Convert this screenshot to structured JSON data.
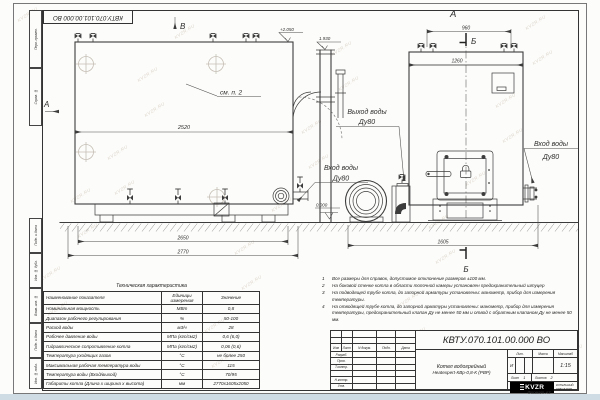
{
  "watermark": "KVZR.RU",
  "stamp": {
    "code": "КВТУ.070.101.00.000  ВО"
  },
  "frame_fields": [
    "Перв. примен.",
    "Справ. №",
    "Подп. и дата",
    "Инв. № дубл.",
    "Взам. инв. №",
    "Подп. и дата",
    "Инв. № подл."
  ],
  "drawing": {
    "view_b_label": "В",
    "view_a_side_label": "А",
    "see_note": "см. п. 2",
    "level_top": "+2.050",
    "level_chimney": "1.930",
    "level_zero": "0.000",
    "dim_2520": "2520",
    "dim_2650": "2650",
    "dim_2770": "2770",
    "front_label": "А",
    "section_label": "Б",
    "dim_960": "960",
    "dim_1260": "1260",
    "dim_1605": "1605",
    "outlet": {
      "line1": "Выход воды",
      "line2": "Ду80"
    },
    "inlet_left": {
      "line1": "Вход воды",
      "line2": "Ду80"
    },
    "inlet_right": {
      "line1": "Вход воды",
      "line2": "Ду80"
    }
  },
  "tech_table": {
    "title": "Техническая характеристика",
    "headers": [
      "Наименование показателя",
      "Единицы измерения",
      "Значение"
    ],
    "rows": [
      [
        "Номинальная мощность",
        "МВт",
        "0,8"
      ],
      [
        "Диапазон рабочего регулирования",
        "%",
        "50-100"
      ],
      [
        "Расход воды",
        "м3/ч",
        "28"
      ],
      [
        "Рабочее давление воды",
        "МПа (кгс/см2)",
        "0,6 (6,0)"
      ],
      [
        "Гидравлическое сопротивление котла",
        "МПа (кгс/см2)",
        "0,06 (0,6)"
      ],
      [
        "Температура уходящих газов",
        "°С",
        "не более 250"
      ],
      [
        "Максимальная рабочая температура воды",
        "°С",
        "115"
      ],
      [
        "Температура воды (Вход/выход)",
        "°С",
        "70/95"
      ],
      [
        "Габариты котла (Длина х ширина х высота)",
        "мм",
        "2770х1605х2050"
      ]
    ]
  },
  "notes": [
    {
      "n": "1",
      "text": "Все размеры для справок, допустимое отклонение размеров ±100 мм."
    },
    {
      "n": "2",
      "text": "На боковой стенке котла в области топочной камеры установлен предохранительный штуцер"
    },
    {
      "n": "3",
      "text": "На подводящей трубе котла, до запорной арматуры установлены: манометр, прибор для измерения температуры."
    },
    {
      "n": "4",
      "text": "На отводящей трубе котла, до запорной арматуры установлены: манометр, прибор для измерения температуры, предохранительный клапан Ду не менее 50 мм и отвод с обратным клапаном Ду не менее 50 мм."
    }
  ],
  "title_block": {
    "designation": "КВТУ.070.101.00.000  ВО",
    "product_line1": "Котел водогрейный",
    "product_line2": "Heatexpert-КВр-0,8-К (РВР)",
    "rev_cols": [
      "Изм",
      "Лист",
      "N докум.",
      "Подп.",
      "Дата"
    ],
    "roles": [
      "Разраб.",
      "Пров.",
      "Т.контр.",
      "Н.контр.",
      "Утв."
    ],
    "lit_label": "Лит.",
    "mass_label": "Масса",
    "scale_label": "Масштаб",
    "lit_value": "И",
    "scale_value": "1:15",
    "sheet_label": "Лист",
    "sheet_value": "1",
    "sheets_label": "Листов",
    "sheets_value": "2",
    "logo_text": "KVZR",
    "company_line1": "КОТЕЛЬНЫЙ",
    "company_line2": "ЗАВОД РЭП",
    "format_label": "Формат  А3"
  }
}
